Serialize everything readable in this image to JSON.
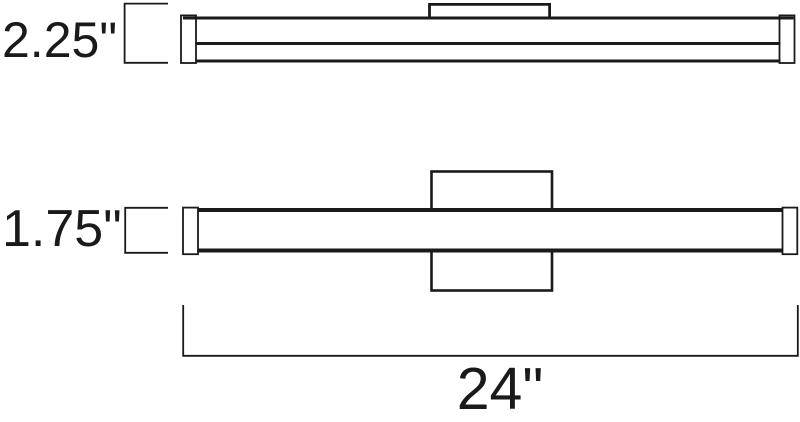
{
  "colors": {
    "line": "#1a1a1a",
    "background": "#ffffff"
  },
  "side_view": {
    "height_label": "2.25\""
  },
  "front_view": {
    "height_label": "1.75\"",
    "width_label": "24\""
  }
}
